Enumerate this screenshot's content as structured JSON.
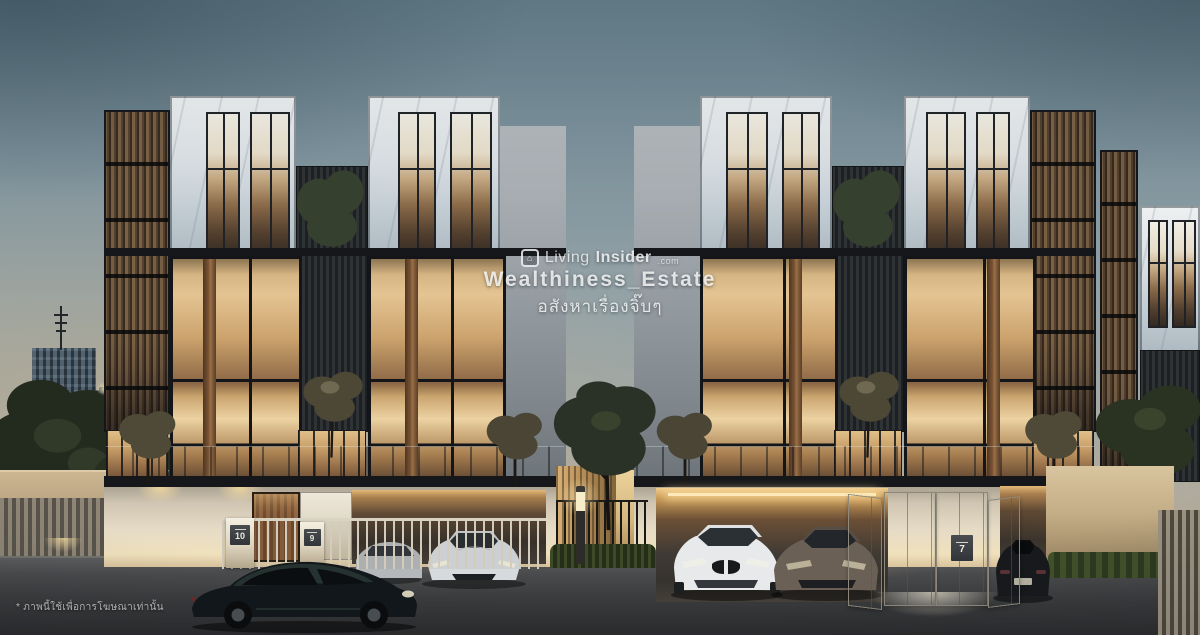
{
  "meta": {
    "description": "Dusk architectural rendering of a modern luxury townhome project with marble and timber-louver facades, warm-lit interiors and parked sports cars",
    "time_of_day": "dusk"
  },
  "watermark": {
    "brand_light": "Living",
    "brand_bold": "Insider",
    "brand_suffix": ".com",
    "account": "Wealthiness_Estate",
    "tagline_th": "อสังหาเรื่องจิ๊บๆ"
  },
  "disclaimer_th": "* ภาพนี้ใช้เพื่อการโฆษณาเท่านั้น",
  "gates": [
    {
      "label": "10"
    },
    {
      "label": "9"
    },
    {
      "label": "7"
    }
  ],
  "icons": {
    "watermark_logo": "livinginsider-box-logo"
  },
  "palette": {
    "sky_top": "#66808c",
    "horizon_warm": "#b7ae9e",
    "marble": "#dae0e4",
    "timber_louver": "#6d5741",
    "dark_cladding": "#1d2023",
    "interior_glow": "#e4c493",
    "podium_cream": "#e6dcc6",
    "road": "#3a3b3d"
  }
}
